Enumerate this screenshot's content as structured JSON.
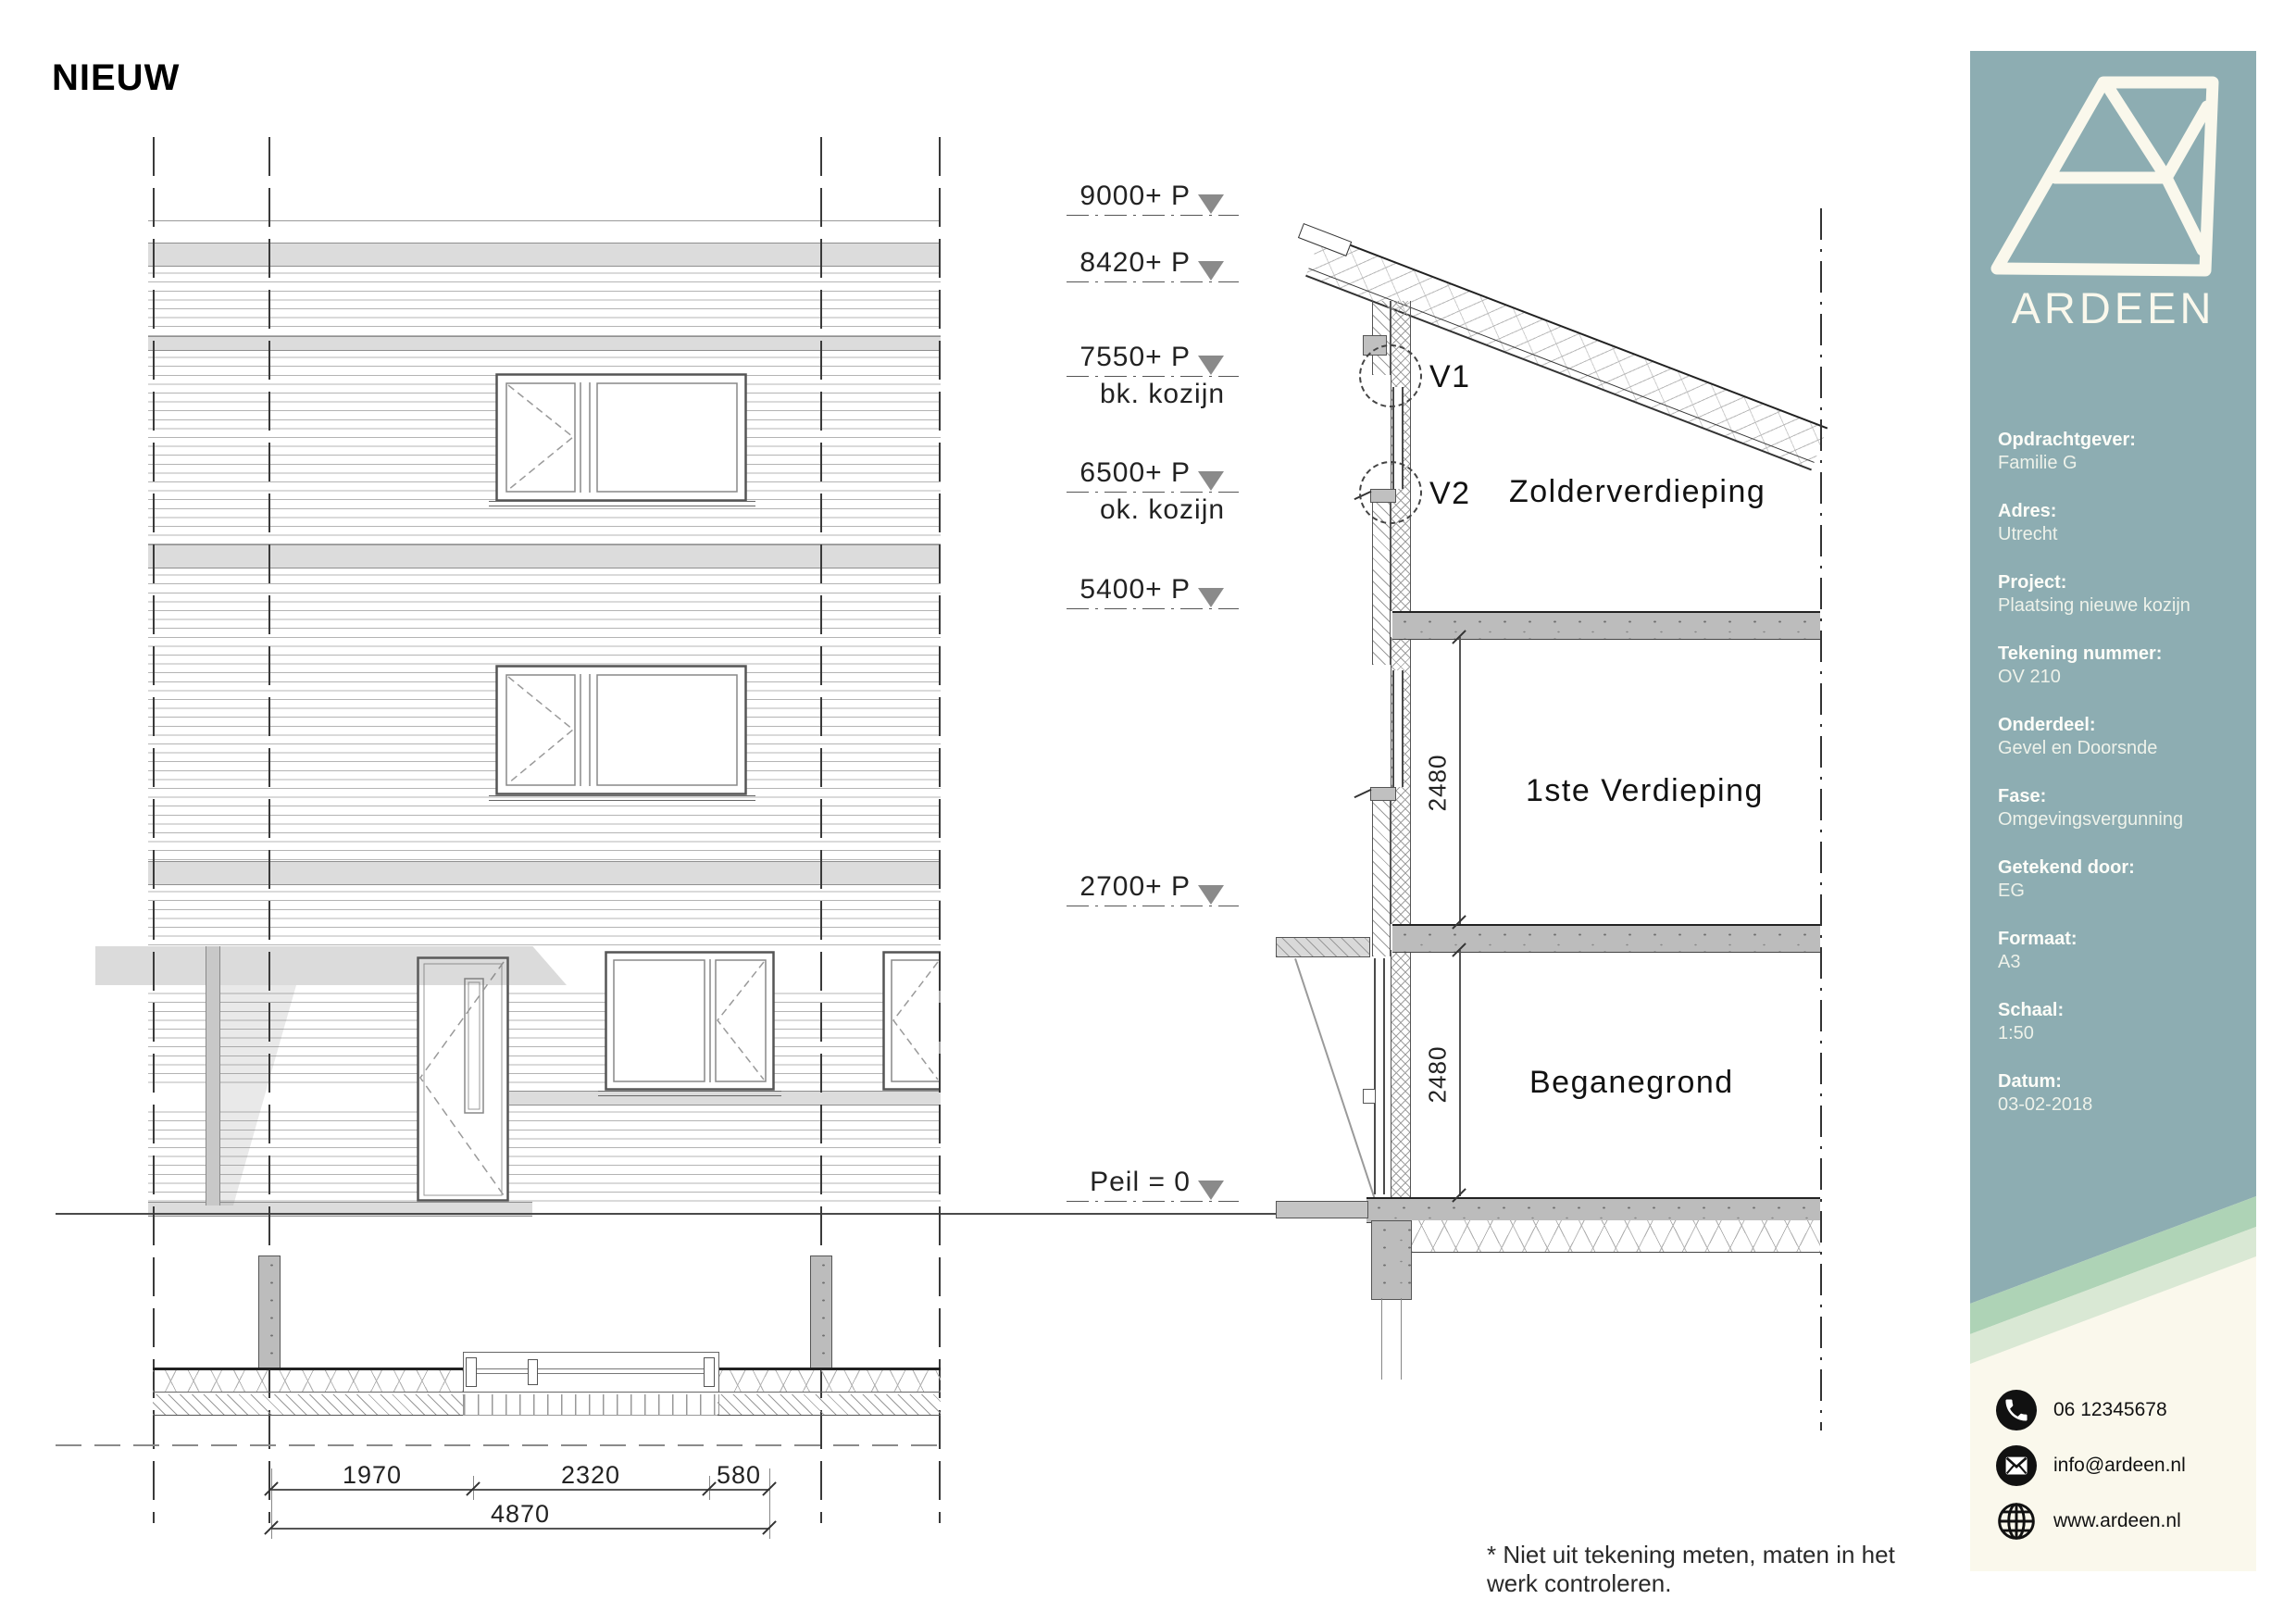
{
  "title": "NIEUW",
  "levels": [
    {
      "label": "9000+ P",
      "sub": ""
    },
    {
      "label": "8420+ P",
      "sub": ""
    },
    {
      "label": "7550+ P",
      "sub": "bk. kozijn"
    },
    {
      "label": "6500+ P",
      "sub": "ok. kozijn"
    },
    {
      "label": "5400+ P",
      "sub": ""
    },
    {
      "label": "2700+ P",
      "sub": ""
    },
    {
      "label": "Peil = 0",
      "sub": ""
    }
  ],
  "section": {
    "detail1": "V1",
    "detail2": "V2",
    "floor_top": "Zolderverdieping",
    "floor_mid": "1ste Verdieping",
    "floor_ground": "Beganegrond",
    "dim_upper": "2480",
    "dim_lower": "2480"
  },
  "plan": {
    "dims": [
      "1970",
      "2320",
      "580"
    ],
    "total": "4870"
  },
  "sidebar": {
    "brand": "ARDEEN",
    "accent_color": "#8dadb2",
    "cream_color": "#faf8ec",
    "stripe_colors": [
      "#aed3b6",
      "#d9e8d4"
    ],
    "info": [
      {
        "label": "Opdrachtgever:",
        "value": "Familie G"
      },
      {
        "label": "Adres:",
        "value": "Utrecht"
      },
      {
        "label": "Project:",
        "value": "Plaatsing nieuwe kozijn"
      },
      {
        "label": "Tekening nummer:",
        "value": "OV 210"
      },
      {
        "label": "Onderdeel:",
        "value": "Gevel en Doorsnde"
      },
      {
        "label": "Fase:",
        "value": "Omgevingsvergunning"
      },
      {
        "label": "Getekend door:",
        "value": "EG"
      },
      {
        "label": "Formaat:",
        "value": "A3"
      },
      {
        "label": "Schaal:",
        "value": "1:50"
      },
      {
        "label": "Datum:",
        "value": "03-02-2018"
      }
    ],
    "contacts": [
      {
        "icon": "phone-icon",
        "value": "06 12345678"
      },
      {
        "icon": "email-icon",
        "value": "info@ardeen.nl"
      },
      {
        "icon": "globe-icon",
        "value": "www.ardeen.nl"
      }
    ]
  },
  "footer": "* Niet uit tekening meten, maten in het werk controleren."
}
